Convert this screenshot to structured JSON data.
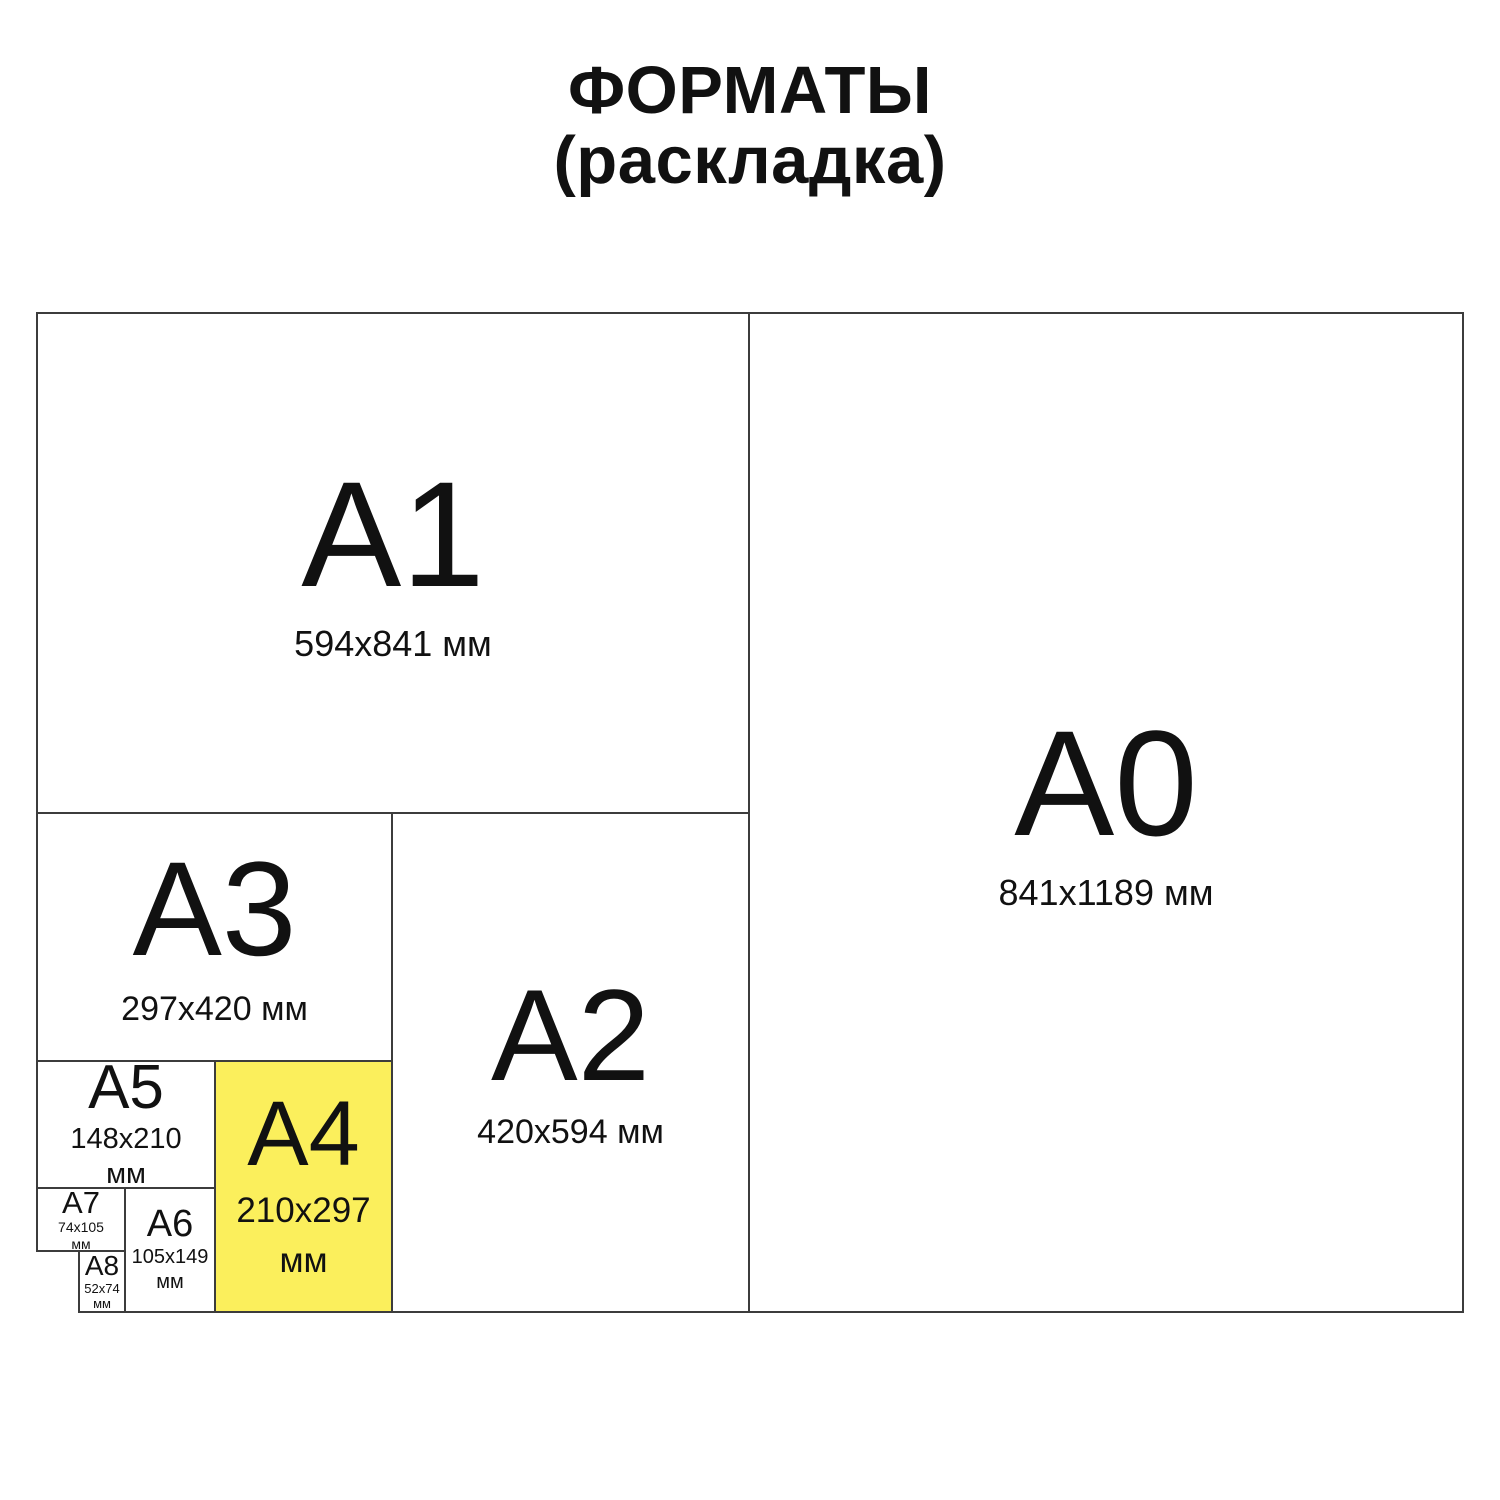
{
  "title": {
    "line1": "ФОРМАТЫ",
    "line2": "(раскладка)"
  },
  "colors": {
    "background": "#FFFFFF",
    "border": "#3C3C3C",
    "text": "#111111",
    "highlight": "#FBEF5C"
  },
  "formats": [
    {
      "name": "A0",
      "size": "841x1189 мм",
      "highlighted": false
    },
    {
      "name": "A1",
      "size": "594x841 мм",
      "highlighted": false
    },
    {
      "name": "A2",
      "size": "420x594 мм",
      "highlighted": false
    },
    {
      "name": "A3",
      "size": "297x420 мм",
      "highlighted": false
    },
    {
      "name": "A4",
      "size": "210x297",
      "unit": "мм",
      "highlighted": true
    },
    {
      "name": "A5",
      "size": "148x210",
      "unit": "мм",
      "highlighted": false
    },
    {
      "name": "A6",
      "size": "105x149",
      "unit": "мм",
      "highlighted": false
    },
    {
      "name": "A7",
      "size": "74x105",
      "unit": "мм",
      "highlighted": false
    },
    {
      "name": "A8",
      "size": "52x74",
      "unit": "мм",
      "highlighted": false
    }
  ]
}
